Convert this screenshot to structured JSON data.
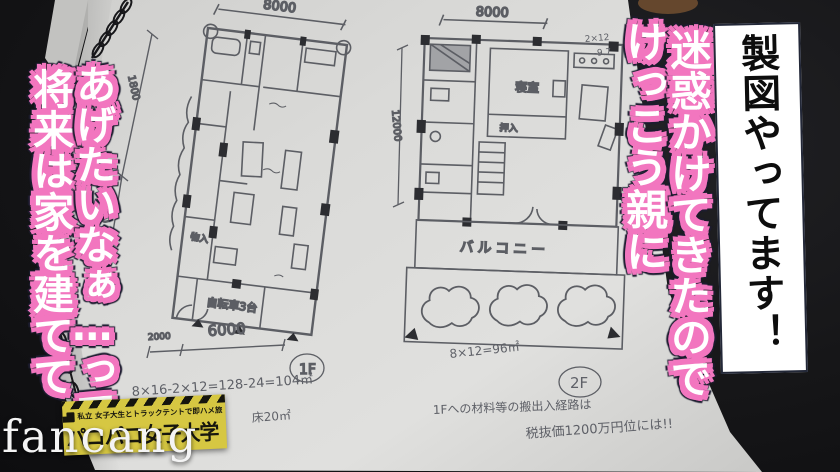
{
  "scene": {
    "background_color": "#141416",
    "page_color": "#d7d7d5",
    "pencil_color": "#63656b",
    "accent_pink": "#f276bf"
  },
  "captions": {
    "banner": {
      "text": "製図やってます！",
      "bg": "#ffffff",
      "text_color": "#0d0d0d"
    },
    "right_block": {
      "col1": "けっこう親に",
      "col2": "迷惑かけてきたので"
    },
    "left_block": {
      "col1": "将来は家を建てて",
      "col2": "あげたいなぁ…って"
    }
  },
  "watermark": {
    "text": "fancang",
    "color": "#f4f4f4"
  },
  "logo": {
    "bg": "#d6c742",
    "tagline": "私立 女子大生とトラックテントで即ハメ旅",
    "title": "パコパコ女子大学"
  },
  "sketch": {
    "plan_left": {
      "top_dim": "8000",
      "left_dim_upper": "1800",
      "left_dim_lower": "2000",
      "bottom_dim_left": "2000",
      "bottom_dim_right": "6000",
      "floor_label": "1F",
      "room_bicycle": "自転車3台",
      "room_storage": "物入",
      "formula_area": "8×16-2×12=128-24=104㎡",
      "formula_floor": "床20㎡"
    },
    "plan_right": {
      "top_dim": "8000",
      "side_dim": "12000",
      "corner_note_1": "2×12",
      "corner_note_2": "-9.7",
      "room_bedroom": "寝室",
      "room_closet": "押入",
      "balcony": "バルコニー",
      "floor_label": "2F",
      "formula_area": "8×12=96㎡",
      "note_route": "1Fへの材料等の搬出入経路は",
      "note_price": "税抜価1200万円位には!!"
    }
  }
}
